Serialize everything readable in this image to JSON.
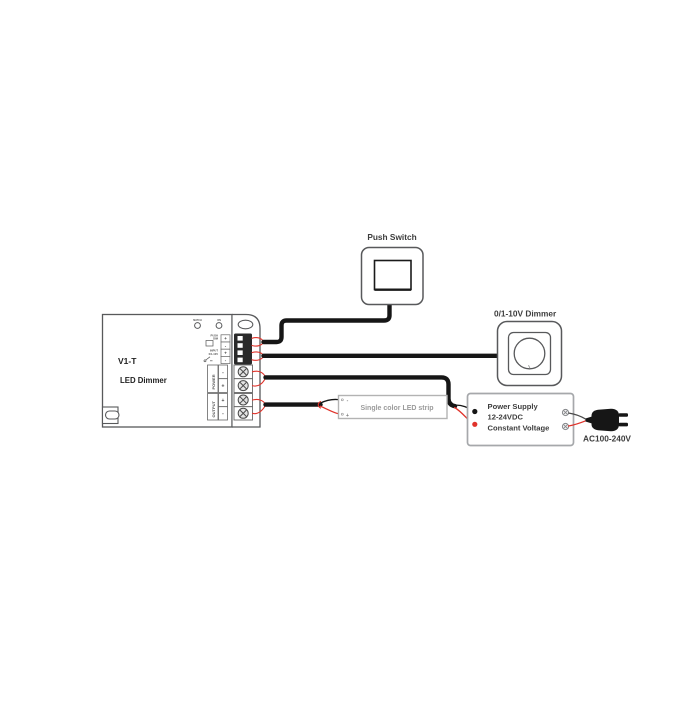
{
  "controller": {
    "model": "V1-T",
    "name": "LED Dimmer",
    "button_labels": [
      "MATCH",
      "ON"
    ],
    "push_dim_label_lines": [
      "PUSH",
      "DIM"
    ],
    "input_label_lines": [
      "INPUT",
      "0/1-10V"
    ],
    "power_label": "POWER",
    "output_label": "OUTPUT",
    "signal_terminal_marks": [
      "+",
      "-",
      "+",
      "-"
    ],
    "power_terminal_marks": [
      "-",
      "+"
    ],
    "output_terminal_marks": [
      "+",
      "-"
    ]
  },
  "push_switch": {
    "label": "Push Switch"
  },
  "analog_dimmer": {
    "label": "0/1-10V Dimmer"
  },
  "led_strip": {
    "label": "Single color LED strip",
    "negative_mark": "-",
    "positive_mark": "+"
  },
  "power_supply": {
    "line1": "Power Supply",
    "line2": "12-24VDC",
    "line3": "Constant Voltage"
  },
  "mains": {
    "label": "AC100-240V"
  },
  "colors": {
    "wire_black": "#161616",
    "lead_red": "#e0332b",
    "outline_grey": "#58595b",
    "psu_border": "#a6a8ab",
    "muted_text": "#9b9b9b"
  }
}
